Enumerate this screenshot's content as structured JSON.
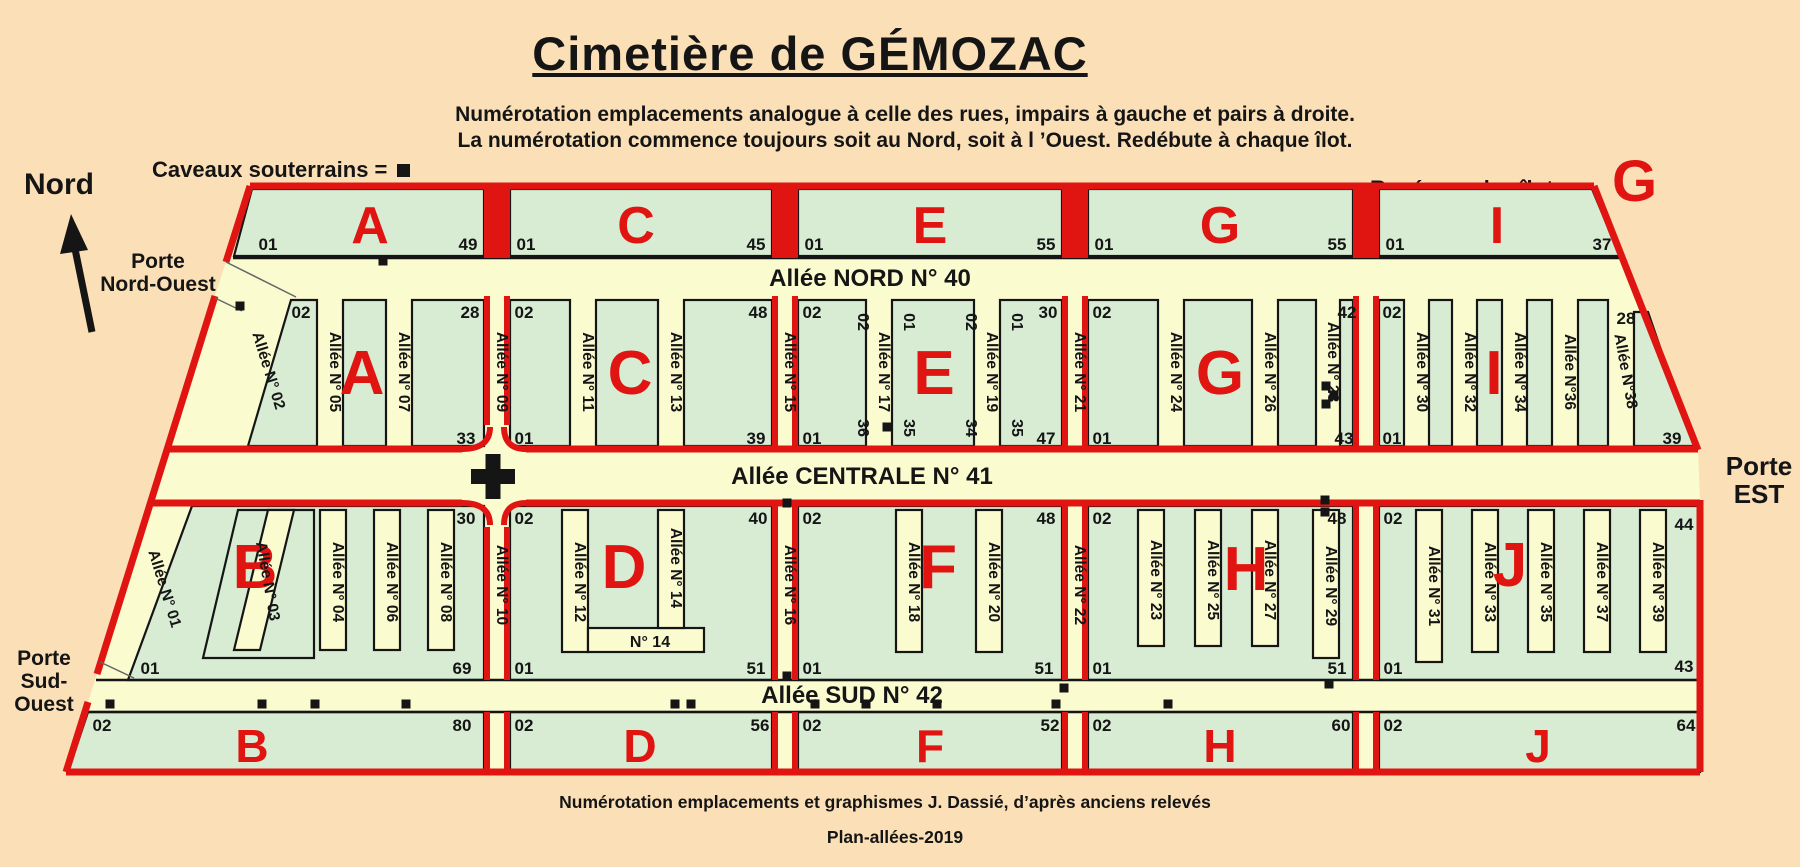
{
  "title": "Cimetière de GÉMOZAC",
  "subtitle": [
    "Numérotation emplacements analogue à celle des rues, impairs à gauche et pairs à droite.",
    "La numérotation commence toujours soit au Nord, soit à l ’Ouest. Redébute à chaque îlot."
  ],
  "legend": {
    "caveaux_label": "Caveaux souterrains =",
    "caveaux_symbol": "black-square",
    "ilots_label": "Repérage des îlots =",
    "ilots_symbol": "G"
  },
  "compass": "Nord",
  "gates": {
    "northwest": [
      "Porte",
      "Nord-Ouest"
    ],
    "southwest": [
      "Porte",
      "Sud-",
      "Ouest"
    ],
    "east": [
      "Porte",
      "EST"
    ]
  },
  "footer": [
    "Numérotation emplacements et graphismes J. Dassié, d’après anciens relevés",
    "Plan-allées-2019"
  ],
  "colors": {
    "background": "#fbdfb6",
    "parcel_green": "#d8ecd4",
    "alley_yellow": "#fbfbd0",
    "boundary_red": "#e01512",
    "text_black": "#151515"
  },
  "plan": {
    "alley_north": "Allée NORD N° 40",
    "alley_central": "Allée CENTRALE N° 41",
    "alley_south": "Allée SUD N° 42",
    "west_alley_north": {
      "label": "Allée N° 02"
    },
    "west_alley_south": {
      "label": "Allée N° 01"
    },
    "dividers_north": [
      "Allée N° 09",
      "Allée N° 15",
      "Allée N° 21",
      ""
    ],
    "dividers_south": [
      "Allée N° 10",
      "Allée N° 16",
      "Allée N° 22",
      ""
    ],
    "top_strips": [
      {
        "letter": "A",
        "start": "01",
        "end": "49"
      },
      {
        "letter": "C",
        "start": "01",
        "end": "45"
      },
      {
        "letter": "E",
        "start": "01",
        "end": "55"
      },
      {
        "letter": "G",
        "start": "01",
        "end": "55"
      },
      {
        "letter": "I",
        "start": "01",
        "end": "37"
      }
    ],
    "north_blocks": [
      {
        "letter": "A",
        "alleys": [
          "Allée N° 05",
          "Allée N° 07"
        ],
        "corners": {
          "tl": "02",
          "tr": "28",
          "bl": "",
          "br": "33"
        }
      },
      {
        "letter": "C",
        "alleys": [
          "Allée N° 11",
          "Allée N° 13"
        ],
        "corners": {
          "tl": "02",
          "tr": "48",
          "bl": "01",
          "br": "39"
        }
      },
      {
        "letter": "E",
        "alleys": [
          "Allée N° 17",
          "Allée N° 19"
        ],
        "corners": {
          "tl": "02",
          "tr": "30",
          "bl": "01",
          "br": "47"
        },
        "top_inner": [
          "02",
          "01",
          "02",
          "01"
        ],
        "bottom_inner": [
          "36",
          "35",
          "34",
          "35"
        ]
      },
      {
        "letter": "G",
        "alleys": [
          "Allée N° 24",
          "Allée N° 26",
          "Allée N° 28"
        ],
        "corners": {
          "tl": "02",
          "tr": "42",
          "bl": "01",
          "br": "43"
        }
      },
      {
        "letter": "I",
        "alleys": [
          "Allée N° 30",
          "Allée N° 32",
          "Allée N° 34",
          "Allée N°36",
          "Allée N°38"
        ],
        "corners": {
          "tl": "02",
          "tr": "28",
          "bl": "01",
          "br": "39"
        }
      }
    ],
    "south_blocks": [
      {
        "letter": "B",
        "alleys": [
          "Allée N° 03",
          "Allée N° 04",
          "Allée N° 06",
          "Allée N° 08"
        ],
        "corners": {
          "tl": "",
          "tr": "30",
          "bl": "01",
          "br": "69"
        }
      },
      {
        "letter": "D",
        "alleys": [
          "Allée N° 12",
          "Allée N° 14"
        ],
        "corners": {
          "tl": "02",
          "tr": "40",
          "bl": "01",
          "br": "51"
        },
        "inner_label": "N° 14"
      },
      {
        "letter": "F",
        "alleys": [
          "Allée N° 18",
          "Allée N° 20"
        ],
        "corners": {
          "tl": "02",
          "tr": "48",
          "bl": "01",
          "br": "51"
        }
      },
      {
        "letter": "H",
        "alleys": [
          "Allée N° 23",
          "Allée N° 25",
          "Allée N° 27",
          "Allée N° 29"
        ],
        "corners": {
          "tl": "02",
          "tr": "48",
          "bl": "01",
          "br": "51"
        }
      },
      {
        "letter": "J",
        "alleys": [
          "Allée N° 31",
          "Allée N° 33",
          "Allée N° 35",
          "Allée N° 37",
          "Allée N° 39"
        ],
        "corners": {
          "tl": "02",
          "tr": "",
          "bl": "01",
          "br": ""
        },
        "right_top": "44",
        "right_bottom": "43"
      }
    ],
    "bottom_strips": [
      {
        "letter": "B",
        "start": "02",
        "end": "80"
      },
      {
        "letter": "D",
        "start": "02",
        "end": "56"
      },
      {
        "letter": "F",
        "start": "02",
        "end": "52"
      },
      {
        "letter": "H",
        "start": "02",
        "end": "60"
      },
      {
        "letter": "J",
        "start": "02",
        "end": "64"
      }
    ],
    "caveaux_positions": [
      [
        240,
        306
      ],
      [
        383,
        261
      ],
      [
        887,
        427
      ],
      [
        1326,
        386
      ],
      [
        1334,
        395
      ],
      [
        1326,
        404
      ],
      [
        1325,
        500
      ],
      [
        1325,
        512
      ],
      [
        787,
        503
      ],
      [
        787,
        676
      ],
      [
        1329,
        684
      ],
      [
        1064,
        688
      ],
      [
        110,
        704
      ],
      [
        262,
        704
      ],
      [
        315,
        704
      ],
      [
        406,
        704
      ],
      [
        675,
        704
      ],
      [
        691,
        704
      ],
      [
        815,
        704
      ],
      [
        866,
        704
      ],
      [
        937,
        704
      ],
      [
        1056,
        704
      ],
      [
        1168,
        704
      ]
    ]
  }
}
